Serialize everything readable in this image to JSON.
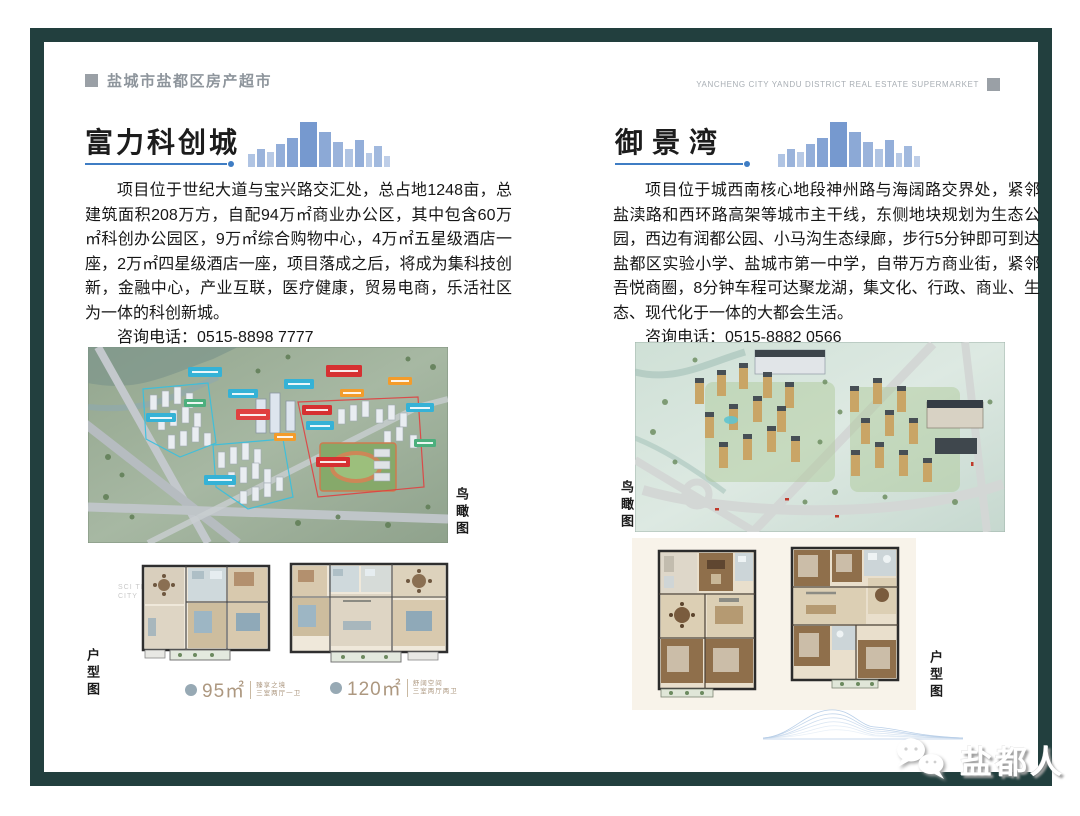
{
  "header": {
    "left_title": "盐城市盐都区房产超市",
    "right_title_en": "YANCHENG CITY YANDU DISTRICT REAL ESTATE SUPERMARKET"
  },
  "listings": [
    {
      "title": "富力科创城",
      "description": "项目位于世纪大道与宝兴路交汇处，总占地1248亩，总建筑面积208万方，自配94万㎡商业办公区，其中包含60万㎡科创办公园区，9万㎡综合购物中心，4万㎡五星级酒店一座，2万㎡四星级酒店一座，项目落成之后，将成为集科技创新，金融中心，产业互联，医疗健康，贸易电商，乐活社区为一体的科创新城。",
      "phone_label": "咨询电话：",
      "phone": "0515-8898 7777",
      "aerial_label": "鸟瞰图",
      "floorplan_label": "户型图",
      "floorplan_watermark": "SCI TECH CITY",
      "floorplans": [
        {
          "area": "95㎡",
          "tagline1": "臻享之境",
          "tagline2": "三室两厅一卫"
        },
        {
          "area": "120㎡",
          "tagline1": "舒阔空间",
          "tagline2": "三室两厅两卫"
        }
      ]
    },
    {
      "title": "御景湾",
      "description": "项目位于城西南核心地段神州路与海阔路交界处，紧邻盐渎路和西环路高架等城市主干线，东侧地块规划为生态公园，西边有润都公园、小马沟生态绿廊，步行5分钟即可到达盐都区实验小学、盐城市第一中学，自带万方商业街，紧邻吾悦商圈，8分钟车程可达聚龙湖，集文化、行政、商业、生态、现代化于一体的大都会生活。",
      "phone_label": "咨询电话：",
      "phone": "0515-8882 0566",
      "aerial_label": "鸟瞰图",
      "floorplan_label": "户型图"
    }
  ],
  "footer": {
    "logo_text": "盐都人"
  },
  "colors": {
    "frame-color": "#223f3e",
    "accent-blue": "#3f7dc4",
    "header-gray": "#9aa0a6",
    "skyline-blue": "#6f93cc",
    "tag-brown": "#ad9880",
    "plan-card-bg": "#f8f3ea",
    "wave-blue": "#b9cfe8"
  }
}
